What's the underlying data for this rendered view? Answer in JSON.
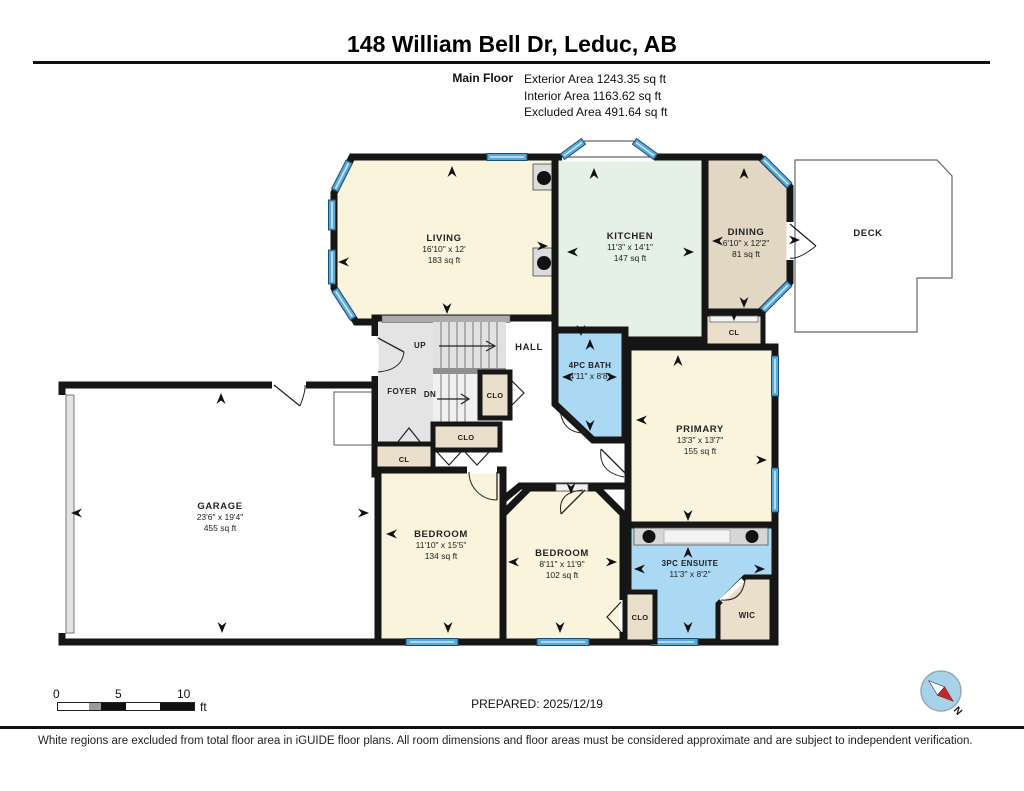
{
  "header": {
    "title": "148 William Bell Dr, Leduc, AB",
    "floor_label": "Main Floor",
    "areas": [
      "Exterior Area 1243.35 sq ft",
      "Interior Area 1163.62 sq ft",
      "Excluded Area 491.64 sq ft"
    ]
  },
  "rooms": {
    "living": {
      "name": "LIVING",
      "dims": "16'10\" x 12'",
      "area": "183 sq ft"
    },
    "kitchen": {
      "name": "KITCHEN",
      "dims": "11'3\" x 14'1\"",
      "area": "147 sq ft"
    },
    "dining": {
      "name": "DINING",
      "dims": "6'10\" x 12'2\"",
      "area": "81 sq ft"
    },
    "deck": {
      "name": "DECK"
    },
    "garage": {
      "name": "GARAGE",
      "dims": "23'6\" x 19'4\"",
      "area": "455 sq ft"
    },
    "foyer": {
      "name": "FOYER"
    },
    "hall": {
      "name": "HALL"
    },
    "stairs_up": {
      "name": "UP"
    },
    "stairs_dn": {
      "name": "DN"
    },
    "bath": {
      "name": "4PC BATH",
      "dims": "4'11\" x 8'8\""
    },
    "primary": {
      "name": "PRIMARY",
      "dims": "13'3\" x 13'7\"",
      "area": "155 sq ft"
    },
    "bedroom1": {
      "name": "BEDROOM",
      "dims": "11'10\" x 15'5\"",
      "area": "134 sq ft"
    },
    "bedroom2": {
      "name": "BEDROOM",
      "dims": "8'11\" x 11'9\"",
      "area": "102 sq ft"
    },
    "ensuite": {
      "name": "3PC ENSUITE",
      "dims": "11'3\" x 8'2\""
    },
    "wic": {
      "name": "WIC"
    },
    "cl_foyer": {
      "name": "CL"
    },
    "clo_hall": {
      "name": "CLO"
    },
    "clo_stairs": {
      "name": "CLO"
    },
    "cl_primary": {
      "name": "CL"
    },
    "clo_ensuite": {
      "name": "CLO"
    }
  },
  "footer": {
    "scale_ticks": [
      "0",
      "5",
      "10"
    ],
    "scale_unit": "ft",
    "prepared": "PREPARED: 2025/12/19",
    "compass": "N",
    "disclaimer": "White regions are excluded from total floor area in iGUIDE floor plans. All room dimensions and floor areas must be considered approximate and are subject to independent verification."
  },
  "colors": {
    "wall": "#161616",
    "cream": "#FBF4DD",
    "mint": "#E5F0E6",
    "tan": "#E1D7C3",
    "closet": "#EADFCB",
    "bath_blue": "#ABD8F2",
    "foyer_gray": "#E4E4E4",
    "window_blue": "#58A8DA",
    "compass_red": "#C52828"
  }
}
